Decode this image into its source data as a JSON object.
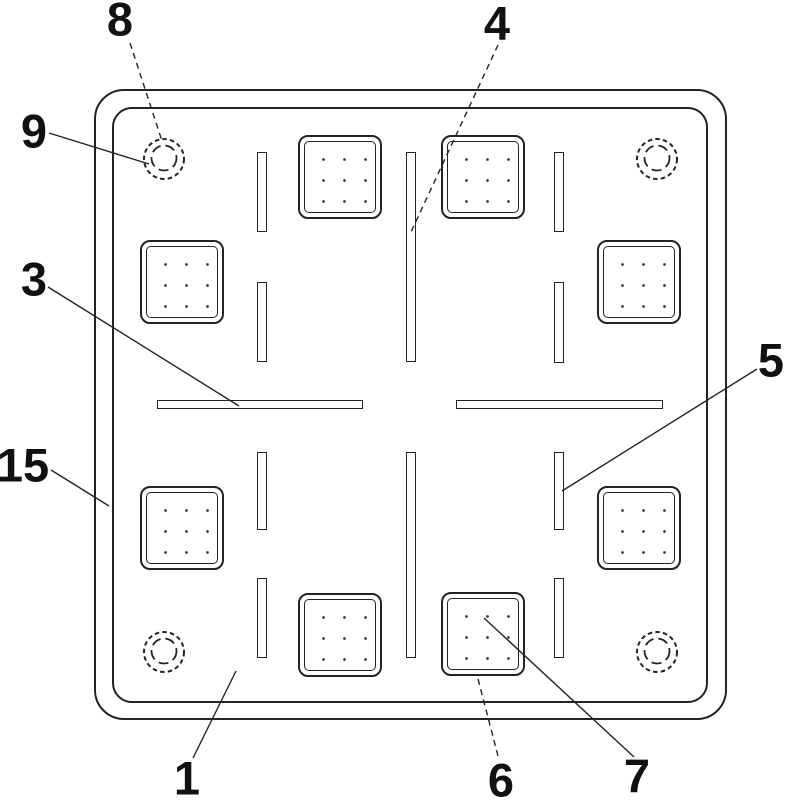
{
  "figure": {
    "description": "Patent-style line drawing: top view of a square plate with rounded corners, four dashed corner holes, eight dotted pad squares, twelve slots, and numbered reference labels with leader lines",
    "background_color": "#ffffff",
    "line_color": "#232323",
    "labels": [
      {
        "id": "8",
        "text": "8",
        "leader_style": "dashed"
      },
      {
        "id": "9",
        "text": "9",
        "leader_style": "solid"
      },
      {
        "id": "3",
        "text": "3",
        "leader_style": "solid"
      },
      {
        "id": "4",
        "text": "4",
        "leader_style": "dashed"
      },
      {
        "id": "5",
        "text": "5",
        "leader_style": "solid"
      },
      {
        "id": "15",
        "text": "15",
        "leader_style": "solid"
      },
      {
        "id": "1",
        "text": "1",
        "leader_style": "solid"
      },
      {
        "id": "6",
        "text": "6",
        "leader_style": "dashed"
      },
      {
        "id": "7",
        "text": "7",
        "leader_style": "solid"
      }
    ]
  }
}
